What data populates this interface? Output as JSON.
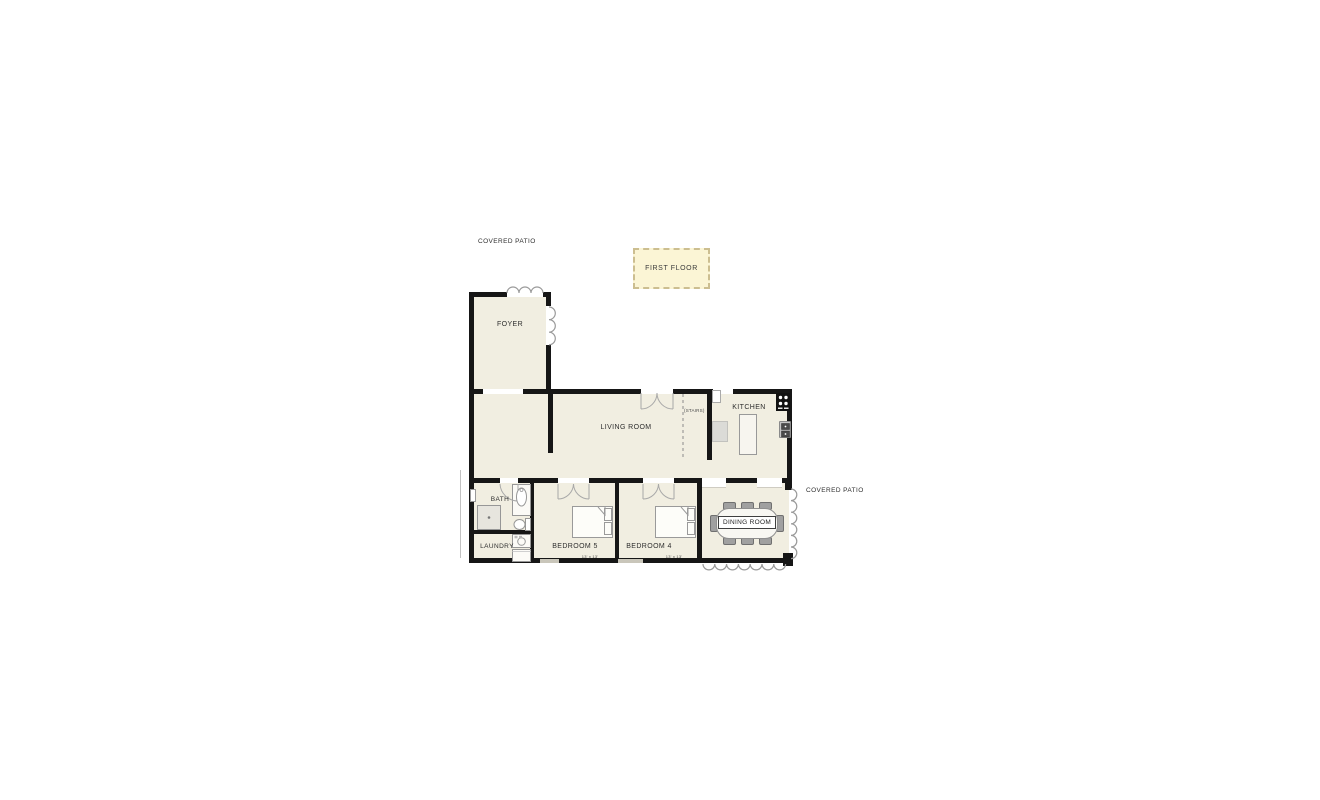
{
  "plan": {
    "legend": {
      "label": "FIRST FLOOR"
    },
    "labels": {
      "covered_patio_top": "COVERED PATIO",
      "covered_patio_right": "COVERED PATIO"
    },
    "rooms": {
      "foyer": {
        "label": "FOYER"
      },
      "living_room": {
        "label": "LIVING ROOM"
      },
      "stairs": {
        "label": "(STAIRS)"
      },
      "kitchen": {
        "label": "KITCHEN"
      },
      "bath": {
        "label": "BATH"
      },
      "laundry": {
        "label": "LAUNDRY"
      },
      "bedroom5": {
        "label": "BEDROOM 5",
        "dims": "13' x 13'"
      },
      "bedroom4": {
        "label": "BEDROOM 4",
        "dims": "13' x 13'"
      },
      "dining": {
        "label": "DINING ROOM"
      }
    },
    "colors": {
      "room_fill": "#f1eee1",
      "wall": "#161616",
      "legend_fill": "#fbf5d5",
      "legend_border": "#ccbe90",
      "fixture_line": "#9a9a9a",
      "text": "#2e2e2e"
    }
  }
}
